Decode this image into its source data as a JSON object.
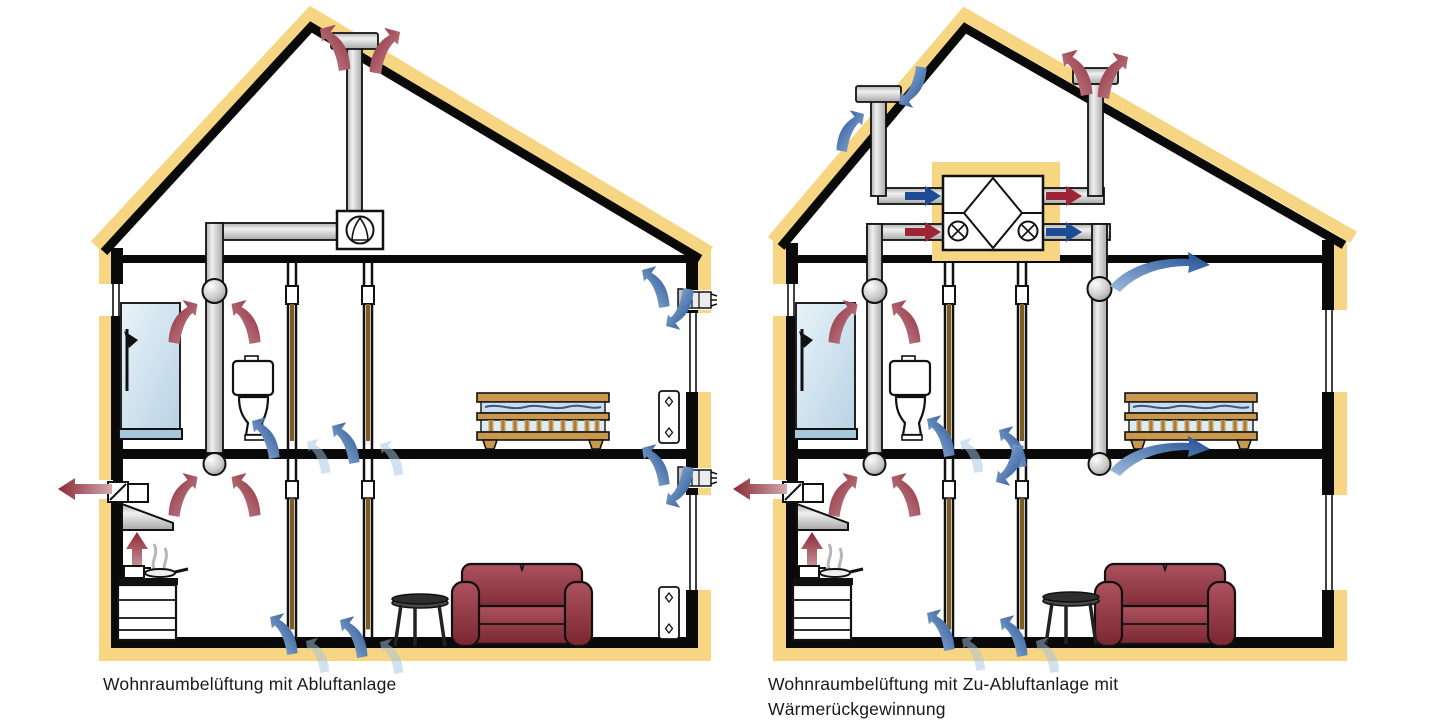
{
  "figures": [
    {
      "id": "abluft",
      "caption": "Wohnraumbelüftung mit Abluftanlage"
    },
    {
      "id": "zu-abluft",
      "caption": "Wohnraumbelüftung mit Zu-Abluftanlage mit\nWärmerückgewinnung"
    }
  ],
  "colors": {
    "background": "#ffffff",
    "insulation_yellow": "#F7D683",
    "structure_black": "#0a0a0a",
    "exhaust_red": "#9E2536",
    "supply_blue": "#1E4C92",
    "duct_gray": "#D9D9D9",
    "sofa_red": "#8D3340",
    "wood_brown": "#C9984C",
    "glass_blue": "#CFE4F0",
    "door_brown": "#7E5C22",
    "caption_text": "#1a1a1a"
  }
}
